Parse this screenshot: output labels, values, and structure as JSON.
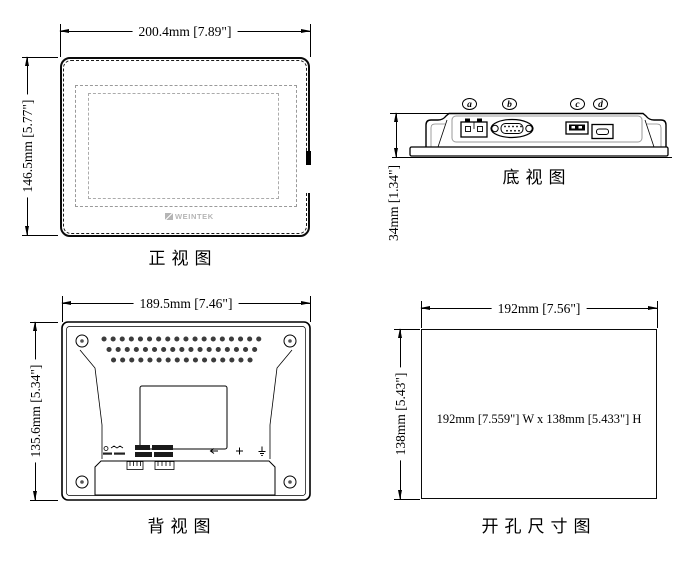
{
  "views": {
    "front": {
      "label": "正视图",
      "width_dim": "200.4mm [7.89\"]",
      "height_dim": "146.5mm [5.77\"]",
      "logo": "WEINTEK"
    },
    "bottom": {
      "label": "底视图",
      "height_dim": "34mm [1.34\"]",
      "ports": {
        "a": "a",
        "b": "b",
        "c": "c",
        "d": "d"
      }
    },
    "rear": {
      "label": "背视图",
      "width_dim": "189.5mm [7.46\"]",
      "height_dim": "135.6mm [5.34\"]"
    },
    "cutout": {
      "label": "开孔尺寸图",
      "width_dim": "192mm [7.56\"]",
      "height_dim": "138mm [5.43\"]",
      "note": "192mm [7.559\"] W x 138mm [5.433\"] H"
    }
  },
  "colors": {
    "line": "#000000",
    "background": "#ffffff",
    "logo_gray": "#b5b5b5",
    "dash_gray": "#9a9a9a"
  }
}
